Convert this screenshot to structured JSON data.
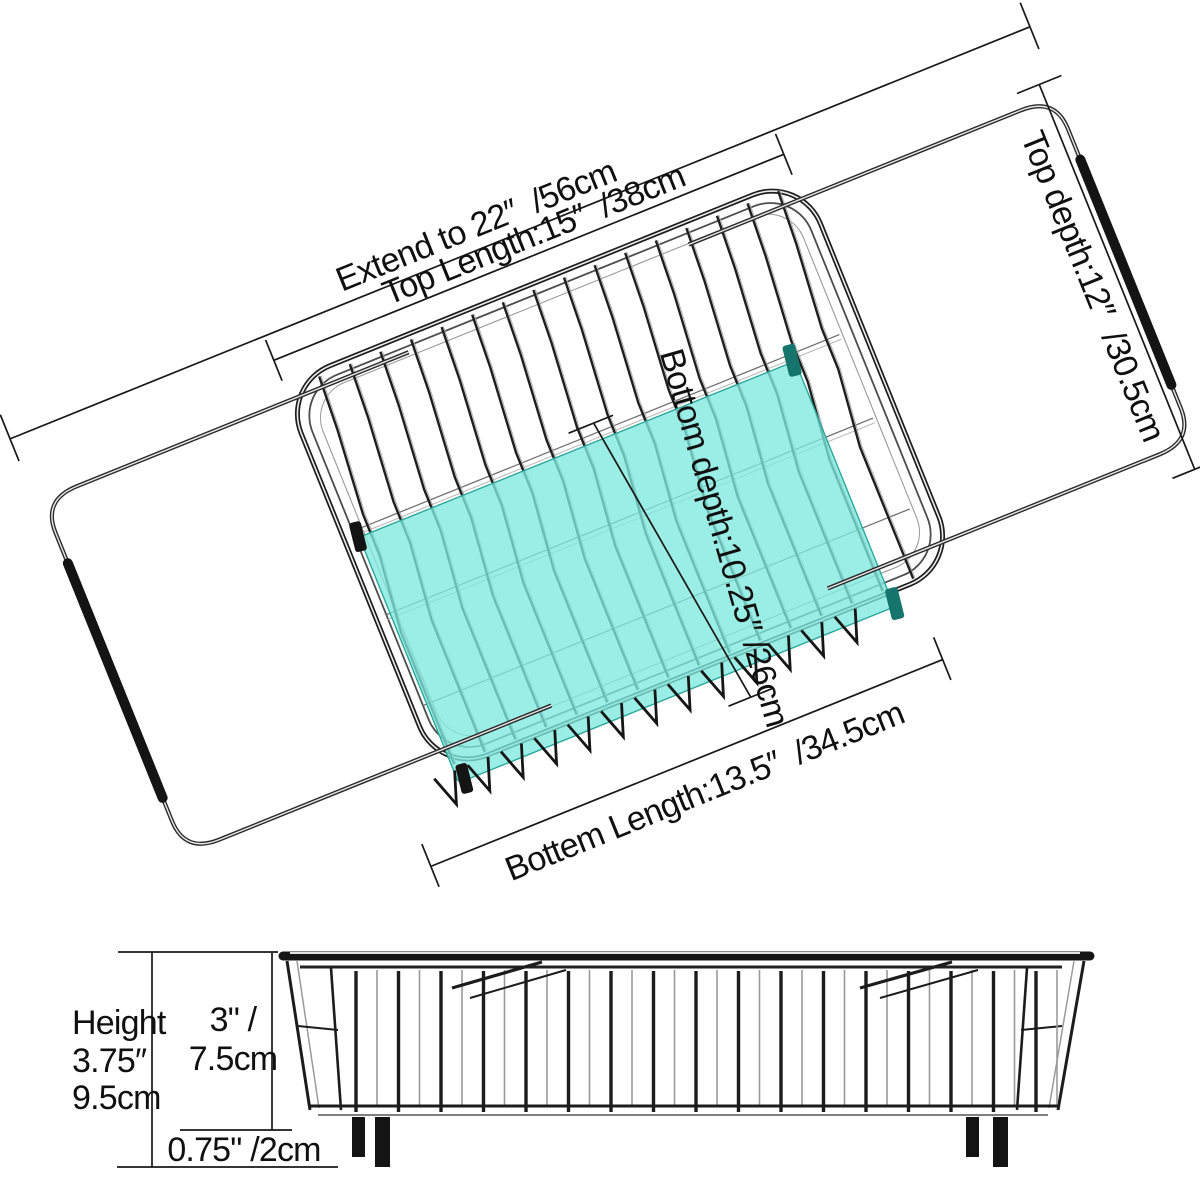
{
  "top_view": {
    "extend_label": "Extend to 22″  /56cm",
    "top_length_label": "Top Length:15″  /38cm",
    "top_depth_label": "Top depth:12″  /30.5cm",
    "bottom_depth_label": "Bottom depth:10.25″ /26cm",
    "bottom_length_label": "Bottem Length:13.5″  /34.5cm"
  },
  "side_view": {
    "height_line1": "Height",
    "height_line2": "3.75″",
    "height_line3": "9.5cm",
    "basket_height_line1": "3\" /",
    "basket_height_line2": "7.5cm",
    "foot_height_label": "0.75\" /2cm"
  },
  "colors": {
    "mat_teal": "#7fe9de",
    "clip_teal_dark": "#15756d",
    "clip_black": "#141414",
    "grip_black": "#141414",
    "wire_black": "#1e1e1e"
  }
}
